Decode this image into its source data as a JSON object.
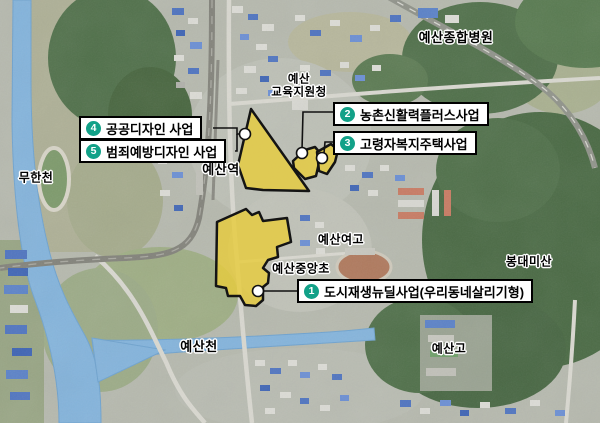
{
  "map": {
    "labels": {
      "hospital": "예산종합병원",
      "education_office_line1": "예산",
      "education_office_line2": "교육지원청",
      "station": "예산역",
      "muhancheon": "무한천",
      "girls_high_school": "예산여고",
      "jungang_elementary": "예산중앙초",
      "bongdaemisan": "봉대미산",
      "yesancheon": "예산천",
      "yesan_high_school": "예산고"
    },
    "callouts": {
      "c1": {
        "num": "1",
        "label": "도시재생뉴딜사업(우리동네살리기형)"
      },
      "c2": {
        "num": "2",
        "label": "농촌신활력플러스사업"
      },
      "c3": {
        "num": "3",
        "label": "고령자복지주택사업"
      },
      "c4": {
        "num": "4",
        "label": "공공디자인 사업"
      },
      "c5": {
        "num": "5",
        "label": "범죄예방디자인 사업"
      }
    },
    "colors": {
      "zone_fill": "#e6cc3e",
      "zone_stroke": "#141414",
      "badge": "#12a188",
      "river": "#84b4dc",
      "forest": "#50704a"
    }
  }
}
